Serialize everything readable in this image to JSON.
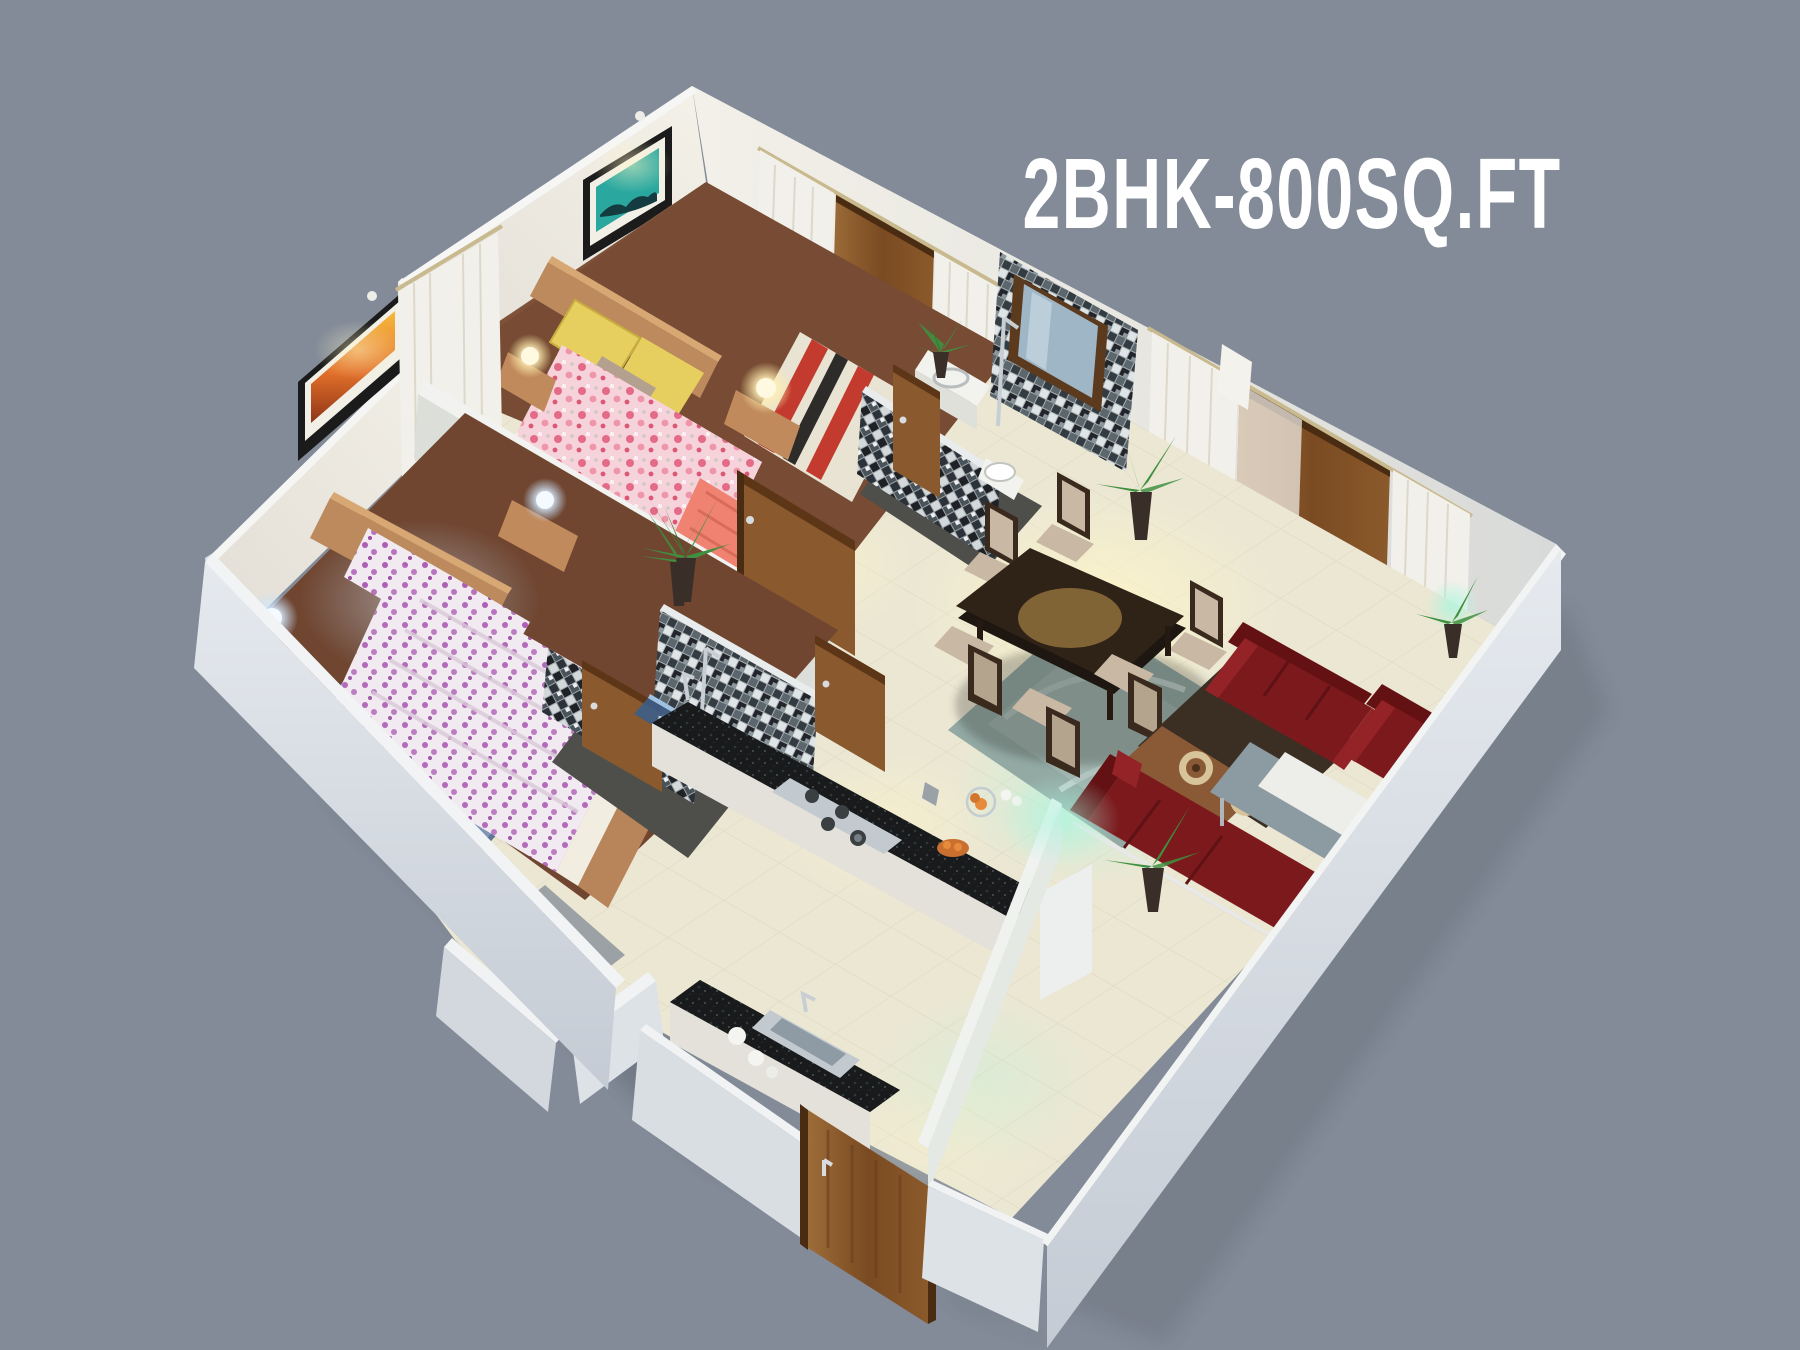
{
  "title": {
    "text": "2BHK-800SQ.FT"
  },
  "colors": {
    "background": "#838B98",
    "title": "#FFFFFF",
    "wall_top": "#F3F5F5",
    "wall_inner": "#EAE9E3",
    "wall_inner_shade": "#DADCD8",
    "wall_outer": "#D0D5DC",
    "floor_cream": "#EBE7D3",
    "floor_wood": "#7F5138",
    "bath_floor": "#4E4E4A",
    "door_wood": "#8A5A2E",
    "sofa": "#7C191D",
    "dining_table": "#2F2318",
    "chair_panel": "#C8B8A4",
    "chair_frame": "#3A2A1E",
    "rug_teal": "#93A9A4",
    "rug_blue": "#7E95B8",
    "rug_brown": "#8A5A36",
    "counter_granite": "#1A1D1F",
    "steel": "#C2CAD0",
    "quilt_pink": "#F5CBD5",
    "quilt_purple": "#F0E7F0",
    "pillow_yellow": "#E6CF5E",
    "blanket_salmon": "#EF8270",
    "bed_frame_wood": "#BC8A5C",
    "plant": "#3F8F3F",
    "glow_teal": "#A5F2DC",
    "curtain": "#F2F0EA"
  }
}
